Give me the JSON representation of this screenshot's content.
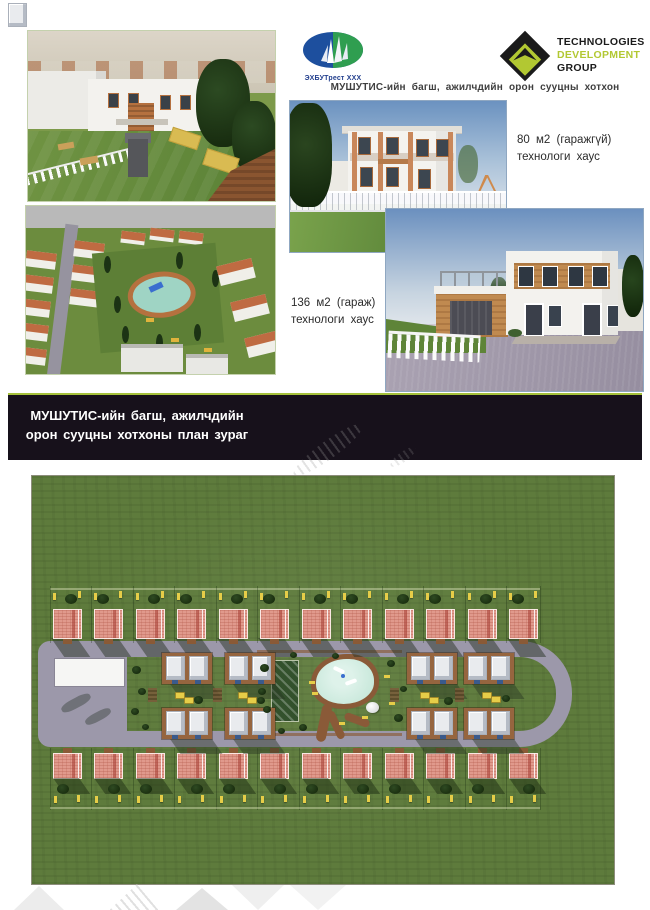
{
  "header": {
    "title": "МУШУТИС-ийн багш, ажилчдийн орон сууцны хотхон"
  },
  "logos": {
    "ehbu": {
      "caption": "ЭХБУТрест XXX"
    },
    "tdg": {
      "line1": "TECHNOLOGIES",
      "line2": "DEVELOPMENT",
      "line3": "GROUP"
    }
  },
  "houses": [
    {
      "line1": "80 м2 (гаражгүй)",
      "line2": "технологи хаус"
    },
    {
      "line1": "136 м2 (гараж)",
      "line2": "технологи хаус"
    }
  ],
  "banner": {
    "line1": "МУШУТИС-ийн багш, ажилчдийн",
    "line2": "орон сууцны хотхоны план зураг"
  },
  "colors": {
    "lime": "#a5c13b",
    "banner_bg": "#17111b",
    "banner_text": "#ffffff",
    "tdg_green": "#b2c832",
    "logo_blue": "#1d4f9e",
    "logo_green": "#2f9e50",
    "grass": "#5e7b3c",
    "road": "#9c98aa",
    "roof_salmon": "#e0998c",
    "duplex_base": "#96653f",
    "duplex_roof": "#e9ebee",
    "pool": "#bfe4d4",
    "court": "#33512c",
    "lamp": "#e6cd48",
    "path_brown": "#8a5a38"
  },
  "plan": {
    "top_house_count": 12,
    "bottom_house_count": 12,
    "duplexes": [
      {
        "x": 130,
        "y": 177
      },
      {
        "x": 193,
        "y": 177
      },
      {
        "x": 130,
        "y": 232
      },
      {
        "x": 193,
        "y": 232
      },
      {
        "x": 375,
        "y": 177
      },
      {
        "x": 432,
        "y": 177
      },
      {
        "x": 375,
        "y": 232
      },
      {
        "x": 432,
        "y": 232
      }
    ],
    "cars": [
      {
        "x": 143,
        "y": 216
      },
      {
        "x": 152,
        "y": 221
      },
      {
        "x": 206,
        "y": 216
      },
      {
        "x": 215,
        "y": 221
      },
      {
        "x": 388,
        "y": 216
      },
      {
        "x": 397,
        "y": 221
      },
      {
        "x": 450,
        "y": 216
      },
      {
        "x": 459,
        "y": 220
      }
    ],
    "pads": [
      {
        "x": 116,
        "y": 212
      },
      {
        "x": 181,
        "y": 212
      },
      {
        "x": 358,
        "y": 212
      },
      {
        "x": 423,
        "y": 212
      }
    ],
    "benches": [
      {
        "x": 277,
        "y": 205
      },
      {
        "x": 280,
        "y": 216
      },
      {
        "x": 352,
        "y": 199
      },
      {
        "x": 357,
        "y": 226
      },
      {
        "x": 307,
        "y": 246
      },
      {
        "x": 330,
        "y": 240
      }
    ],
    "park_trees": [
      {
        "x": 228,
        "y": 188,
        "s": 9
      },
      {
        "x": 226,
        "y": 212,
        "s": 8
      },
      {
        "x": 231,
        "y": 230,
        "s": 8
      },
      {
        "x": 258,
        "y": 176,
        "s": 7
      },
      {
        "x": 267,
        "y": 248,
        "s": 8
      },
      {
        "x": 300,
        "y": 177,
        "s": 7
      },
      {
        "x": 355,
        "y": 184,
        "s": 8
      },
      {
        "x": 362,
        "y": 238,
        "s": 9
      },
      {
        "x": 246,
        "y": 252,
        "s": 7
      },
      {
        "x": 368,
        "y": 210,
        "s": 7
      }
    ],
    "strip_trees": [
      {
        "x": 100,
        "y": 190,
        "s": 9
      },
      {
        "x": 106,
        "y": 212,
        "s": 8
      },
      {
        "x": 99,
        "y": 232,
        "s": 8
      },
      {
        "x": 110,
        "y": 248,
        "s": 7
      }
    ],
    "mid_trees": [
      {
        "x": 162,
        "y": 220,
        "s": 9
      },
      {
        "x": 225,
        "y": 221,
        "s": 8
      },
      {
        "x": 412,
        "y": 221,
        "s": 9
      },
      {
        "x": 470,
        "y": 219,
        "s": 8
      }
    ],
    "parking_shadows": [
      {
        "x": 28,
        "y": 222,
        "w": 32,
        "h": 10
      },
      {
        "x": 52,
        "y": 236,
        "w": 28,
        "h": 9
      }
    ]
  }
}
